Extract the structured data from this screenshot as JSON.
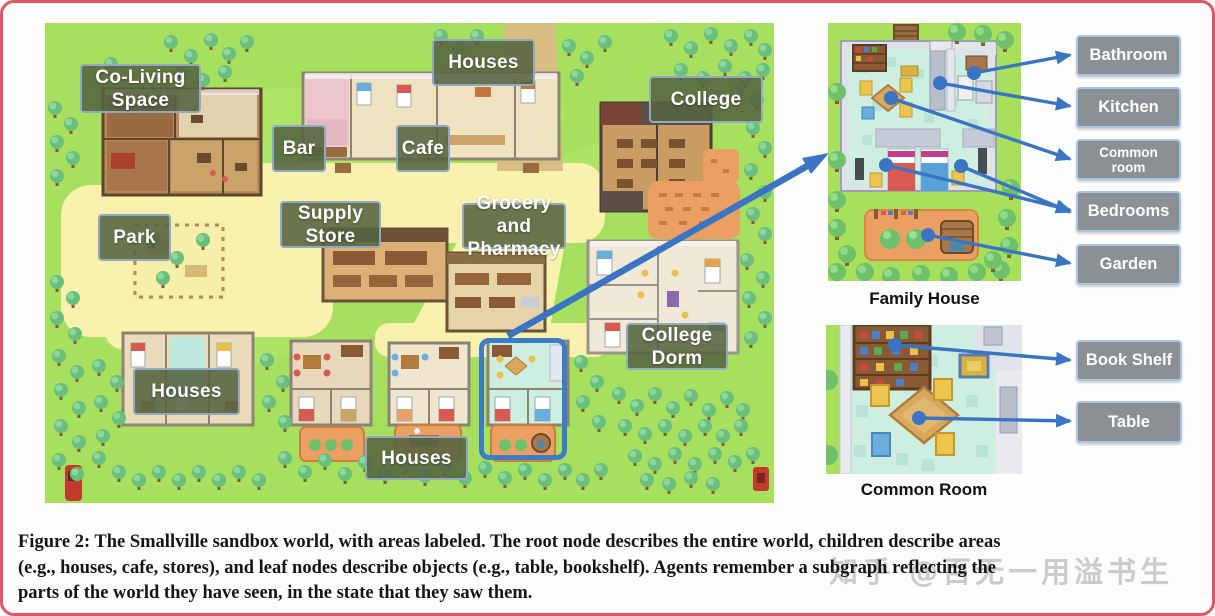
{
  "figure": {
    "caption_lines": [
      "Figure 2: The Smallville sandbox world, with areas labeled. The root node describes the entire world, children describe areas",
      "(e.g., houses, cafe, stores), and leaf nodes describe objects (e.g., table, bookshelf). Agents remember a subgraph reflecting the",
      "parts of the world they have seen, in the state that they saw them."
    ],
    "watermark": "知乎 @百无一用溢书生"
  },
  "map": {
    "name": "Smallville sandbox world map",
    "labels": [
      {
        "id": "co-living-space",
        "text": "Co-Living\nSpace"
      },
      {
        "id": "houses-top",
        "text": "Houses"
      },
      {
        "id": "college",
        "text": "College"
      },
      {
        "id": "bar",
        "text": "Bar"
      },
      {
        "id": "cafe",
        "text": "Cafe"
      },
      {
        "id": "supply-store",
        "text": "Supply\nStore"
      },
      {
        "id": "grocery-and-pharmacy",
        "text": "Grocery and\nPharmacy"
      },
      {
        "id": "park",
        "text": "Park"
      },
      {
        "id": "college-dorm",
        "text": "College\nDorm"
      },
      {
        "id": "houses-left",
        "text": "Houses"
      },
      {
        "id": "houses-bottom",
        "text": "Houses"
      }
    ]
  },
  "panels": {
    "family_house": {
      "caption": "Family House",
      "labels": [
        "Bathroom",
        "Kitchen",
        "Common\nroom",
        "Bedrooms",
        "Garden"
      ]
    },
    "common_room": {
      "caption": "Common Room",
      "labels": [
        "Book Shelf",
        "Table"
      ]
    }
  },
  "colors": {
    "arrow_blue": "#3a74c2",
    "frame_red": "#e05665",
    "map_label_bg": "rgba(85,99,64,0.88)",
    "map_label_border": "#92aac1",
    "side_label_bg": "#8a9094",
    "side_label_border": "#a9c6e8",
    "highlight_box": "#3f7cc8"
  }
}
